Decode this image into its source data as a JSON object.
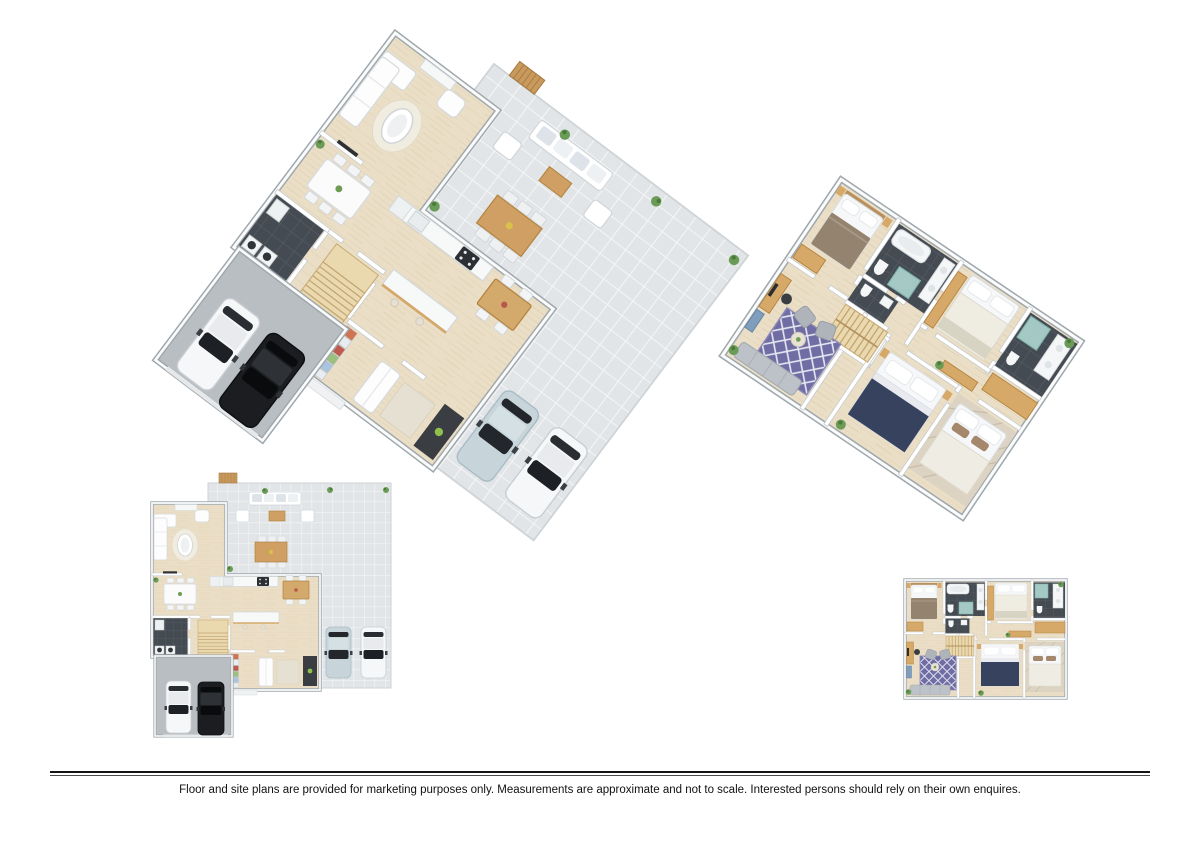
{
  "page": {
    "background_color": "#ffffff"
  },
  "divider": {
    "color": "#141414"
  },
  "disclaimer": {
    "text": "Floor and site plans are provided for marketing purposes only. Measurements are approximate and not to scale. Interested persons should rely on their own enquires."
  },
  "plan_views": [
    "ground-floor-3d-plan",
    "upper-floor-3d-plan",
    "ground-floor-2d-plan",
    "upper-floor-2d-plan"
  ],
  "palette": {
    "wood_floor": "#eadec6",
    "patio_tile": "#e2e5e7",
    "garage_floor": "#b9bec3",
    "dark_bathroom_tile": "#454b52",
    "wall_white": "#ffffff",
    "wall_edge_gray": "#9fa8ad",
    "stair_wood": "#ead9ae",
    "cabinet_tan": "#d6a968",
    "rug_purple": "#6f6da4",
    "bed_navy": "#37425f",
    "blanket_brown": "#94836e",
    "car_black": "#1b1d20",
    "car_white": "#f6f7f8",
    "car_light_blue": "#c7d5db",
    "plant_green": "#6a9c57",
    "shower_glass_teal": "#b5ded8"
  }
}
